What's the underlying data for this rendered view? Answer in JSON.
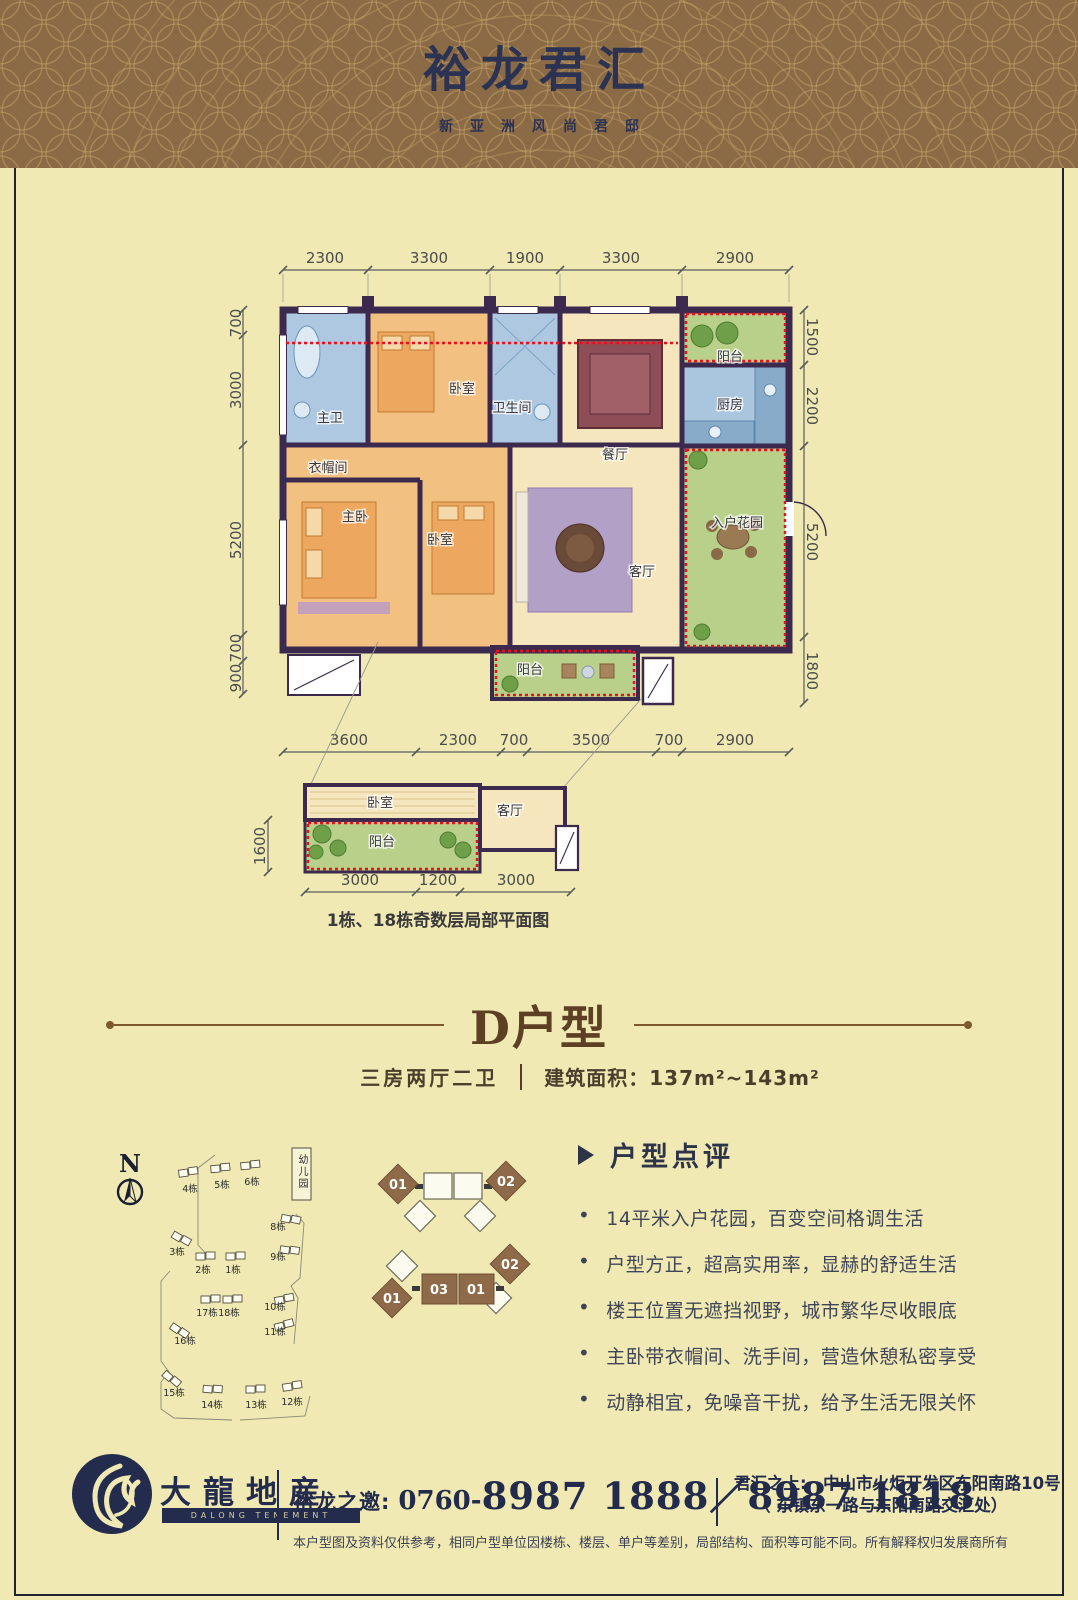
{
  "colors": {
    "page_bg": "#f0e9b4",
    "header_bg": "#8b6a46",
    "navy": "#2b3252",
    "brown_title": "#5d4023",
    "wall": "#3c2a4e",
    "red_dotted": "#e8101c",
    "footer_navy": "#242c4e"
  },
  "header": {
    "title": "裕龙君汇",
    "subtitle": "新亚洲风尚君邸"
  },
  "plan": {
    "dims_top": [
      "2300",
      "3300",
      "1900",
      "3300",
      "2900"
    ],
    "dims_left": [
      "700",
      "3000",
      "5200",
      "700",
      "900"
    ],
    "dims_right": [
      "1500",
      "2200",
      "5200",
      "1800"
    ],
    "dims_bottom": [
      "3600",
      "2300",
      "700",
      "3500",
      "700",
      "2900"
    ],
    "rooms": {
      "master_bath": "主卫",
      "bedroom1": "卧室",
      "bathroom": "卫生间",
      "dining": "餐厅",
      "balcony_top": "阳台",
      "kitchen": "厨房",
      "cloakroom": "衣帽间",
      "master_bedroom": "主卧",
      "bedroom2": "卧室",
      "living": "客厅",
      "entry_garden": "入户花园",
      "balcony_bottom": "阳台"
    }
  },
  "partial": {
    "rooms": {
      "bedroom": "卧室",
      "living": "客厅",
      "balcony": "阳台"
    },
    "dim_left": "1600",
    "dims_bottom": [
      "3000",
      "1200",
      "3000"
    ],
    "caption": "1栋、18栋奇数层局部平面图"
  },
  "unit": {
    "title": "D户型",
    "layout": "三房两厅二卫",
    "area": "建筑面积：137m²~143m²"
  },
  "site": {
    "north": "N",
    "kindergarten": "幼儿园",
    "buildings": [
      "4栋",
      "5栋",
      "6栋",
      "3栋",
      "2栋",
      "1栋",
      "8栋",
      "9栋",
      "17栋",
      "18栋",
      "16栋",
      "10栋",
      "11栋",
      "15栋",
      "14栋",
      "13栋",
      "12栋"
    ]
  },
  "keyplans": {
    "a": [
      "01",
      "02"
    ],
    "b": [
      "01",
      "03",
      "01",
      "02"
    ]
  },
  "review": {
    "heading": "户型点评",
    "bullets": [
      "14平米入户花园，百变空间格调生活",
      "户型方正，超高实用率，显赫的舒适生活",
      "楼王位置无遮挡视野，城市繁华尽收眼底",
      "主卧带衣帽间、洗手间，营造休憩私密享受",
      "动静相宜，免噪音干扰，给予生活无限关怀"
    ]
  },
  "footer": {
    "logo_cn": "大龍地産",
    "logo_en": "DALONG TENEMENT",
    "invite_label": "裕龙之邀:",
    "phone_prefix": "0760-",
    "phone_numbers": "8987 1888／8987 1818",
    "addr_label": "君汇之上:",
    "addr_line1": "中山市火炬开发区东阳南路10号",
    "addr_line2": "（ 东镇东一路与东阳南路交汇处）",
    "disclaimer": "本户型图及资料仅供参考，相同户型单位因楼栋、楼层、单户等差别，局部结构、面积等可能不同。所有解释权归发展商所有"
  }
}
